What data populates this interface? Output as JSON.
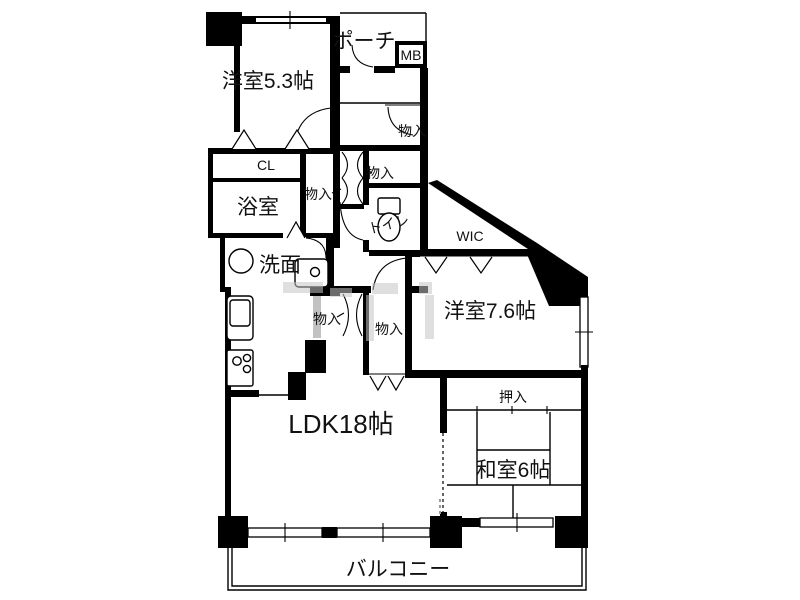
{
  "figure_type": "japanese-apartment-floor-plan",
  "colors": {
    "wall": "#000000",
    "background": "#ffffff",
    "watermark": "#c5c5c5"
  },
  "rooms": {
    "yoshitsu53": {
      "label": "洋室5.3帖"
    },
    "porch": {
      "label": "ポーチ"
    },
    "mb": {
      "label": "MB"
    },
    "monoire_entry": {
      "label": "物入"
    },
    "monoire_hall_upper": {
      "label": "物入"
    },
    "monoire_hall_lower": {
      "label": "物入"
    },
    "monoire_ldk_small": {
      "label": "物入"
    },
    "monoire_ldk_large": {
      "label": "物入"
    },
    "cl": {
      "label": "CL"
    },
    "bathroom": {
      "label": "浴室"
    },
    "washroom": {
      "label": "洗面"
    },
    "toilet": {
      "label": "トイレ"
    },
    "wic": {
      "label": "WIC"
    },
    "yoshitsu76": {
      "label": "洋室7.6帖"
    },
    "oshiire": {
      "label": "押入"
    },
    "ldk": {
      "label": "LDK18帖"
    },
    "washitsu": {
      "label": "和室6帖"
    },
    "balcony": {
      "label": "バルコニー"
    }
  }
}
